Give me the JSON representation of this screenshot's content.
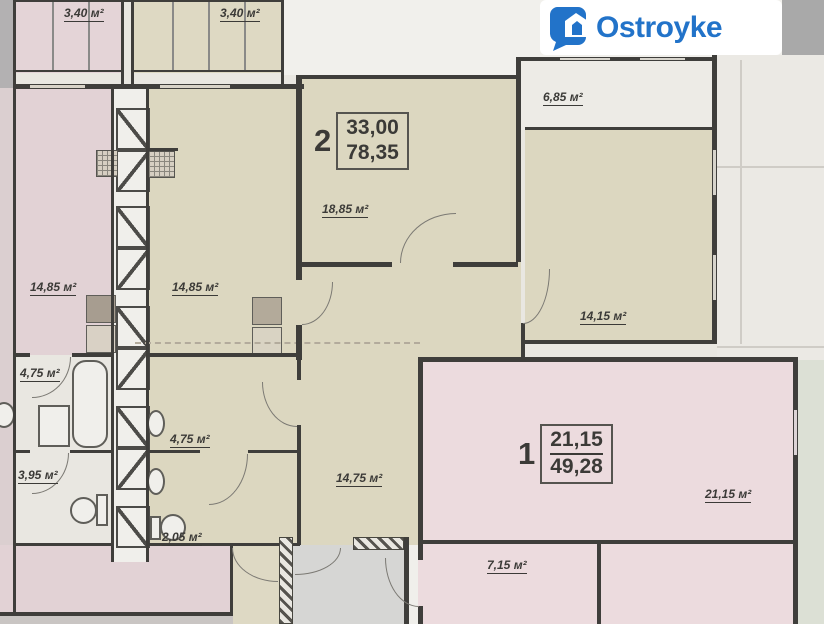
{
  "logo": {
    "text": "Ostroyke",
    "brand_color": "#2273c9"
  },
  "apartments": {
    "apt2": {
      "number": "2",
      "living_area": "33,00",
      "total_area": "78,35"
    },
    "apt1": {
      "number": "1",
      "living_area": "21,15",
      "total_area": "49,28"
    }
  },
  "rooms": {
    "balcony_left": "3,40 м²",
    "balcony_mid": "3,40 м²",
    "room_left": "14,85 м²",
    "room_mid": "14,85 м²",
    "room_top": "18,85 м²",
    "room_top_right": "6,85 м²",
    "room_right": "14,15 м²",
    "hall": "14,75 м²",
    "bath_left": "4,75 м²",
    "wc_left": "3,95 м²",
    "bath_mid": "4,75 м²",
    "wc_mid": "2,05 м²",
    "apt1_room": "21,15 м²",
    "apt1_room2": "7,15 м²"
  },
  "colors": {
    "wall": "#3f3e3b",
    "beige_room": "#dcd7c0",
    "pink_room": "#e2d2d5",
    "pink_room_light": "#ecdbde",
    "paper": "#e9e7e1",
    "logo_blue": "#2273c9"
  }
}
